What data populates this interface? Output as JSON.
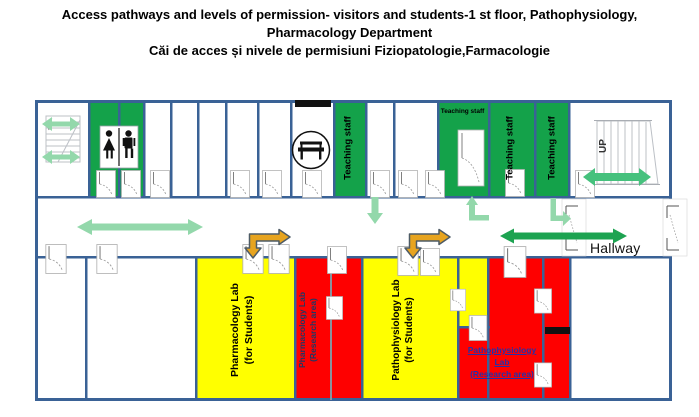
{
  "title": {
    "line1": "Access pathways and levels of permission- visitors and students-1 st  floor, Pathophysiology,",
    "line2": "Pharmacology Department",
    "line3": "Căi de acces și nivele de permisiuni Fiziopatologie,Farmacologie"
  },
  "rooms": {
    "teaching_staff": "Teaching staff",
    "pharmacology_students": {
      "line1": "Pharmacology  Lab",
      "line2": "(for Students)"
    },
    "pharmacology_research": {
      "line1": "Pharmacology  Lab",
      "line2": "(Research area)"
    },
    "pathophysiology_students": {
      "line1": "Pathophysiology Lab",
      "line2": "(for Students)"
    },
    "pathophysiology_research": {
      "line1": "Pathophysiology",
      "line2": "Lab",
      "line3": "(Research area)"
    }
  },
  "labels": {
    "hallway": "Hallway",
    "up": "UP"
  },
  "icons": {
    "restroom_icon": "woman-and-man-figures",
    "bench_icon": "bench-in-circle",
    "stairs_icon": "staircase-sketch"
  },
  "colors": {
    "wall": "#3A6296",
    "room_green": "#14A24A",
    "room_yellow": "#FFFF00",
    "room_red": "#FE0000",
    "arrow_light_green": "#93D8AB",
    "arrow_green": "#1DA351",
    "arrow_stairs_green": "#46C17D",
    "arrow_orange": "#E7A41F",
    "arrow_orange_outline": "#4D5B66",
    "research_text_blue": "#1F3864",
    "research_link_blue": "#2531A8"
  }
}
